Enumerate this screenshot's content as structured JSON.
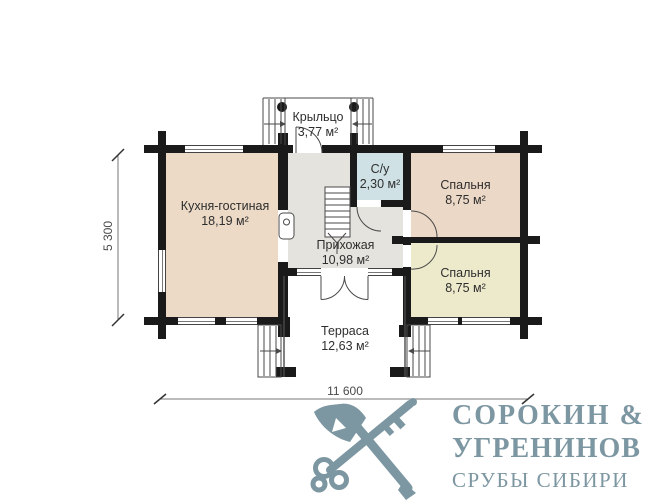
{
  "rooms": {
    "porch": {
      "name": "Крыльцо",
      "area": "3,77 м²"
    },
    "kitchen": {
      "name": "Кухня-гостиная",
      "area": "18,19 м²"
    },
    "wc": {
      "name": "С/у",
      "area": "2,30 м²"
    },
    "bedroom_top": {
      "name": "Спальня",
      "area": "8,75 м²"
    },
    "bedroom_bottom": {
      "name": "Спальня",
      "area": "8,75 м²"
    },
    "hallway": {
      "name": "Прихожая",
      "area": "10,98 м²"
    },
    "terrace": {
      "name": "Терраса",
      "area": "12,63 м²"
    }
  },
  "dimensions": {
    "width_label": "11 600",
    "depth_label": "5 300"
  },
  "colors": {
    "wall": "#1a1a1a",
    "kitchen_fill": "#ecd9c6",
    "bedroom_top_fill": "#ecd8c7",
    "bedroom_bottom_fill": "#edeacc",
    "wc_fill": "#cfe1e5",
    "hallway_fill": "#e4e3de",
    "brand": "#7d97a2"
  },
  "brand": {
    "name_line1": "СОРОКИН &",
    "name_line2": "УГРЕНИНОВ",
    "tagline": "СРУБЫ СИБИРИ"
  }
}
